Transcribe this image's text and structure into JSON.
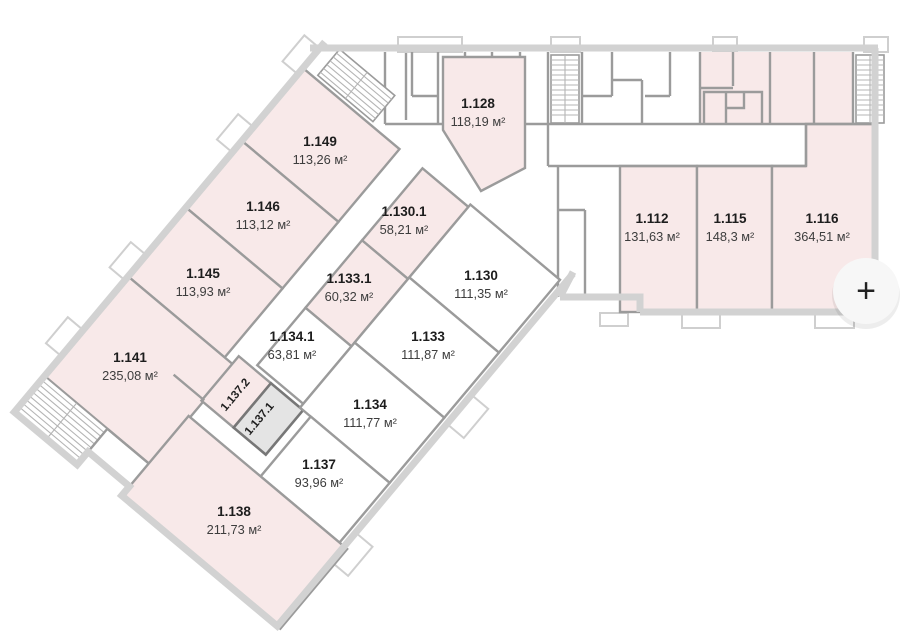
{
  "palette": {
    "available_fill": "#f8e9e9",
    "unavailable_fill": "#ffffff",
    "selected_fill": "#e4e4e4",
    "wall": "#9b9b9b",
    "outer_wall": "#d2d2d2",
    "label_text": "#1d1d1d",
    "area_text": "#3d3d3d"
  },
  "controls": {
    "zoom_in_label": "+"
  },
  "rooms": [
    {
      "id": "1.128",
      "area": "118,19 м²",
      "status": "available"
    },
    {
      "id": "1.149",
      "area": "113,26 м²",
      "status": "available"
    },
    {
      "id": "1.146",
      "area": "113,12 м²",
      "status": "available"
    },
    {
      "id": "1.145",
      "area": "113,93 м²",
      "status": "available"
    },
    {
      "id": "1.141",
      "area": "235,08 м²",
      "status": "available"
    },
    {
      "id": "1.130.1",
      "area": "58,21 м²",
      "status": "available"
    },
    {
      "id": "1.133.1",
      "area": "60,32 м²",
      "status": "available"
    },
    {
      "id": "1.134.1",
      "area": "63,81 м²",
      "status": "unavailable"
    },
    {
      "id": "1.130",
      "area": "111,35 м²",
      "status": "unavailable"
    },
    {
      "id": "1.133",
      "area": "111,87 м²",
      "status": "unavailable"
    },
    {
      "id": "1.134",
      "area": "111,77 м²",
      "status": "unavailable"
    },
    {
      "id": "1.137",
      "area": "93,96 м²",
      "status": "unavailable"
    },
    {
      "id": "1.138",
      "area": "211,73 м²",
      "status": "available"
    },
    {
      "id": "1.112",
      "area": "131,63 м²",
      "status": "available"
    },
    {
      "id": "1.115",
      "area": "148,3 м²",
      "status": "available"
    },
    {
      "id": "1.116",
      "area": "364,51 м²",
      "status": "available"
    },
    {
      "id": "1.137.2",
      "status": "available"
    },
    {
      "id": "1.137.1",
      "status": "selected"
    }
  ]
}
